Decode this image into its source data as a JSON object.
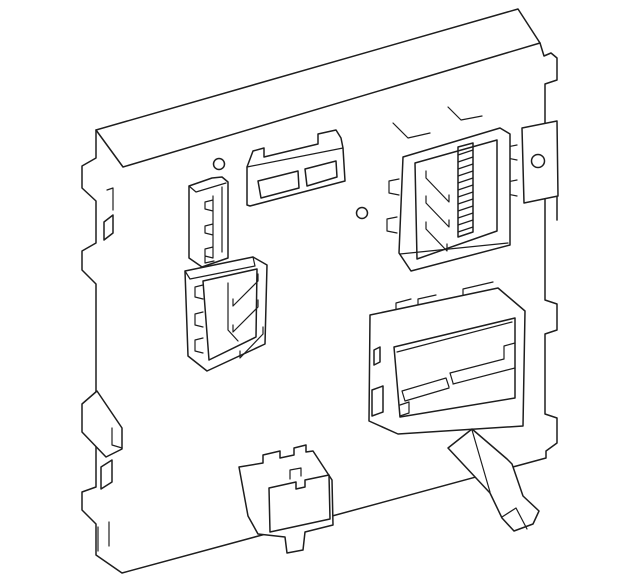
{
  "canvas": {
    "width": 640,
    "height": 586,
    "background_color": "#ffffff",
    "line_color": "#1e1e1e"
  },
  "diagram": {
    "kind": "technical line illustration",
    "subject": "vehicle body control module (fuse box), isometric three-quarter view, no text labels",
    "parts": [
      "module-plate",
      "top-flange",
      "left-mounting-tabs",
      "left-mounting-foot",
      "right-mounting-bracket-with-hole",
      "screw-hole-left",
      "screw-hole-center",
      "two-slot-connector-top",
      "vertical-connector-left",
      "mid-left-connector",
      "top-right-connector-hatched",
      "bottom-right-connector",
      "bottom-connector",
      "release-lever"
    ]
  }
}
